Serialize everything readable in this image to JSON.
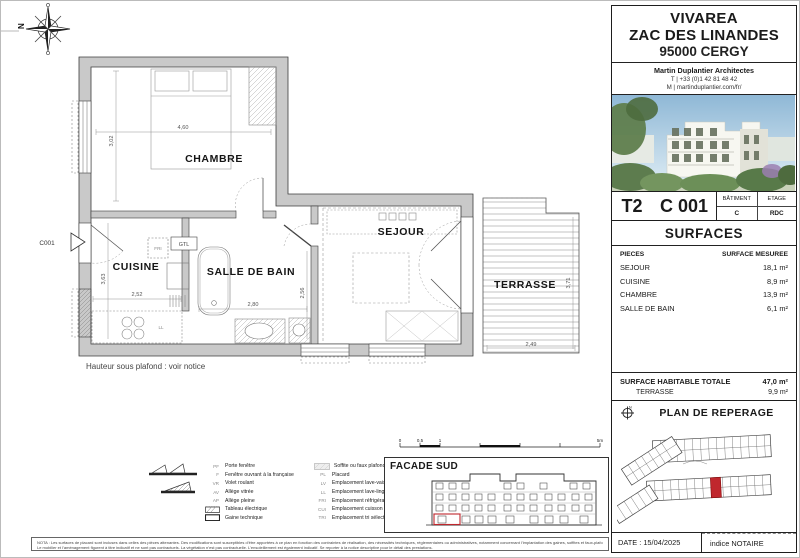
{
  "colors": {
    "highlight_red": "#c0272d",
    "wall_gray": "#c9c9c9"
  },
  "plan": {
    "rooms": {
      "chambre": "CHAMBRE",
      "cuisine": "CUISINE",
      "salle_de_bain": "SALLE DE BAIN",
      "sejour": "SEJOUR",
      "terrasse": "TERRASSE"
    },
    "unit_ref": "C001",
    "labels": {
      "gtl": "GTL",
      "fri": "FRI",
      "ll": "LL"
    },
    "dims": {
      "chambre_w": "4,60",
      "chambre_h": "3,02",
      "cuisine_h": "3,63",
      "cuisine_w": "2,52",
      "sdb_w": "2,80",
      "sdb_h": "2,56",
      "terrasse_w": "2,49",
      "terrasse_h": "3,71"
    },
    "ceiling_note": "Hauteur sous plafond : voir notice"
  },
  "legend": {
    "left": [
      {
        "code": "PF",
        "label": "Porte fenêtre"
      },
      {
        "code": "F",
        "label": "Fenêtre ouvrant à la française"
      },
      {
        "code": "VR",
        "label": "Volet roulant"
      },
      {
        "code": "AV",
        "label": "Allège vitrée"
      },
      {
        "code": "AP",
        "label": "Allège pleine"
      },
      {
        "code": "",
        "label": "Tableau électrique"
      },
      {
        "code": "",
        "label": "Gaine technique"
      }
    ],
    "right": [
      {
        "code": "",
        "label": "Soffite ou faux plafond"
      },
      {
        "code": "PL",
        "label": "Placard"
      },
      {
        "code": "LV",
        "label": "Emplacement lave-vaisselle"
      },
      {
        "code": "LL",
        "label": "Emplacement lave-linge"
      },
      {
        "code": "FRI",
        "label": "Emplacement réfrigérateur"
      },
      {
        "code": "CUI",
        "label": "Emplacement cuisson"
      },
      {
        "code": "TRI",
        "label": "Emplacement tri sélectif"
      }
    ]
  },
  "scalebar": {
    "t0": "0",
    "t05": "0,5",
    "t1": "1",
    "t5": "5m"
  },
  "facade": {
    "title": "FACADE SUD"
  },
  "titleblock": {
    "project": {
      "name": "VIVAREA",
      "line2": "ZAC DES LINANDES",
      "line3": "95000 CERGY"
    },
    "architect": {
      "name": "Martin Duplantier Architectes",
      "phone": "T  | +33 (0)1 42 81 48 42",
      "web": "M | martinduplantier.com/fr/"
    },
    "unit": {
      "type": "T2",
      "number": "C 001",
      "batiment_label": "BÂTIMENT",
      "batiment": "C",
      "etage_label": "ETAGE",
      "etage": "RDC"
    },
    "surfaces": {
      "title": "SURFACES",
      "col1": "PIECES",
      "col2": "SURFACE MESUREE",
      "rows": [
        [
          "SEJOUR",
          "18,1 m²"
        ],
        [
          "CUISINE",
          "8,9 m²"
        ],
        [
          "CHAMBRE",
          "13,9 m²"
        ],
        [
          "SALLE DE BAIN",
          "6,1 m²"
        ]
      ],
      "total_label": "SURFACE HABITABLE TOTALE",
      "total": "47,0 m²",
      "terrasse_label": "TERRASSE",
      "terrasse": "9,9 m²"
    },
    "reperage_title": "PLAN DE REPERAGE",
    "date": "DATE : 15/04/2025",
    "indice": "indice NOTAIRE"
  },
  "footer": {
    "nota1": "NOTA : Les surfaces de placard sont incluses dans celles des pièces attenantes. Des modifications sont susceptibles d’être apportées à ce plan en fonction des contraintes de réalisation, des nécessités techniques, réglementaires ou administratives, notamment concernant l’implantation des gaines, soffites et faux-plafonds.",
    "nota2": "Le mobilier et l’aménagement figurent à titre indicatif et ne sont pas contractuels. La végétation n’est pas contractuelle. L’ensoleillement est également indicatif. Se reporter à la notice descriptive pour le détail des prestations."
  }
}
